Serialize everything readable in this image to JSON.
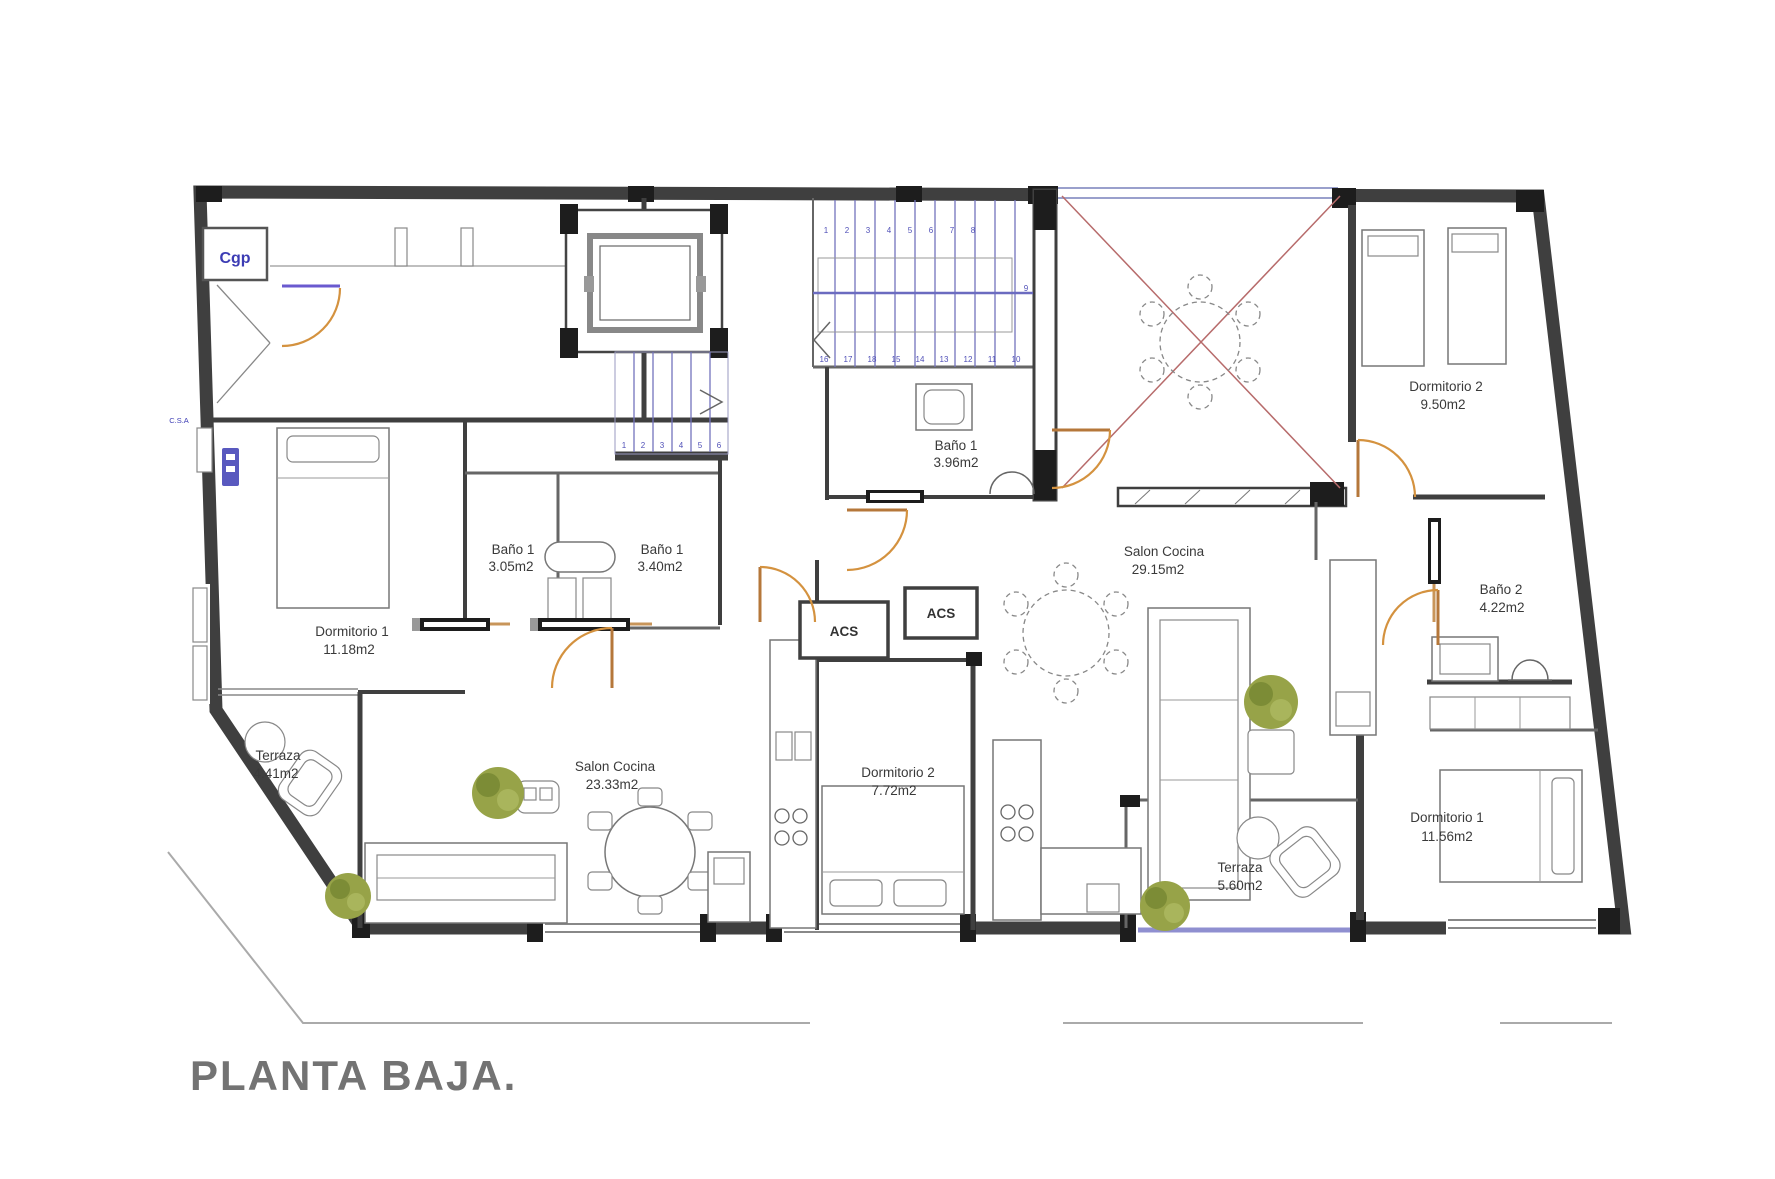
{
  "title": "PLANTA BAJA.",
  "labels": {
    "cgp": "Cgp",
    "csa": "C.S.A",
    "acs_left": "ACS",
    "acs_right": "ACS"
  },
  "rooms": {
    "left_dormitorio1": {
      "name": "Dormitorio 1",
      "area": "11.18m2"
    },
    "left_bano_a": {
      "name": "Baño 1",
      "area": "3.05m2"
    },
    "left_bano_b": {
      "name": "Baño 1",
      "area": "3.40m2"
    },
    "left_salon": {
      "name": "Salon Cocina",
      "area": "23.33m2"
    },
    "left_terraza": {
      "name": "Terraza",
      "area": "4.41m2"
    },
    "center_dormitorio2": {
      "name": "Dormitorio 2",
      "area": "7.72m2"
    },
    "center_bano1": {
      "name": "Baño 1",
      "area": "3.96m2"
    },
    "right_salon": {
      "name": "Salon Cocina",
      "area": "29.15m2"
    },
    "right_dormitorio2": {
      "name": "Dormitorio 2",
      "area": "9.50m2"
    },
    "right_bano2": {
      "name": "Baño 2",
      "area": "4.22m2"
    },
    "right_dormitorio1": {
      "name": "Dormitorio 1",
      "area": "11.56m2"
    },
    "right_terraza": {
      "name": "Terraza",
      "area": "5.60m2"
    }
  },
  "stairs": {
    "main_top": [
      "1",
      "2",
      "3",
      "4",
      "5",
      "6",
      "7",
      "8"
    ],
    "main_mid": "9",
    "main_bottom": [
      "16",
      "17",
      "18",
      "15",
      "14",
      "13",
      "12",
      "11",
      "10"
    ],
    "service": [
      "1",
      "2",
      "3",
      "4",
      "5",
      "6"
    ]
  },
  "colors": {
    "wall": "#3f3f3f",
    "door_arc": "#d4923f",
    "stair_tread": "#7373bd",
    "window_sill": "#8f8fd0",
    "patio_cross": "#b76b6b",
    "plant_green": "#8a9a3e",
    "title_gray": "#737373",
    "label_gray": "#3a3a3a",
    "blue_text": "#3c3cb4"
  }
}
